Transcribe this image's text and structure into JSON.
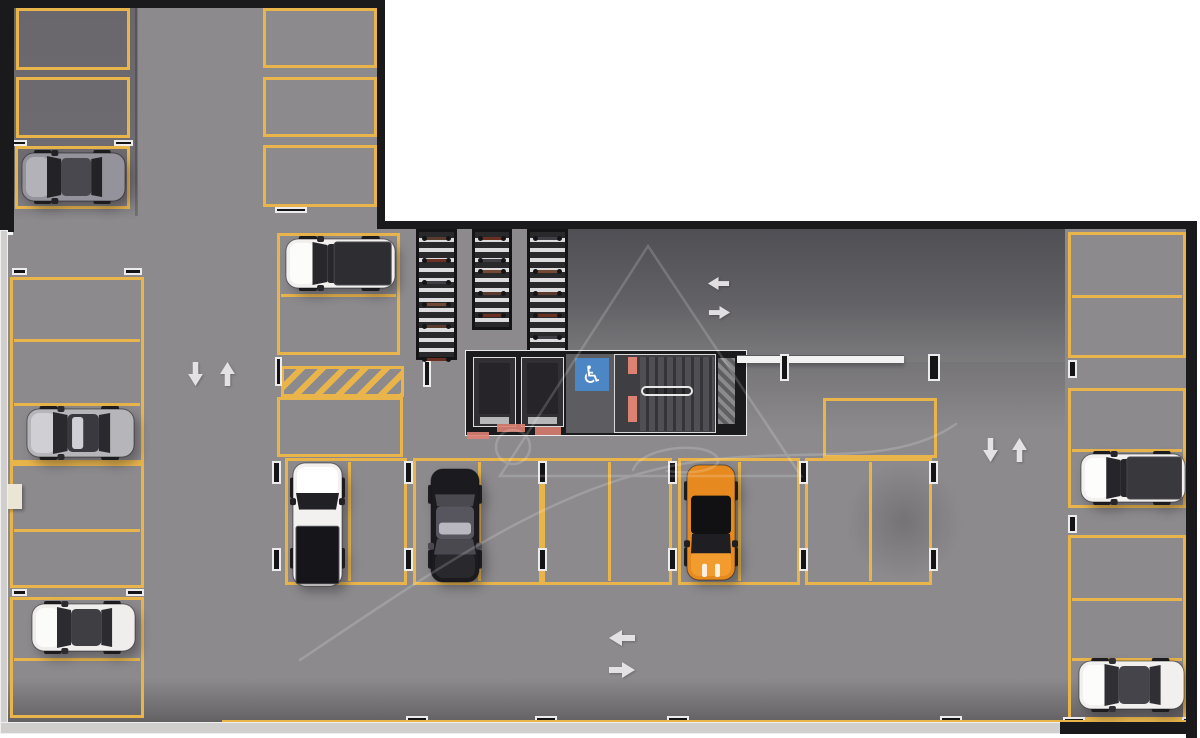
{
  "scene": {
    "type": "parking-garage-floor-plan",
    "view": "top-down-3d-render",
    "width": 1200,
    "height": 738
  },
  "palette": {
    "floor": "#8c8a8d",
    "floor_dark_nook": "#6d6b6f",
    "floor_dark_zone": "#565559",
    "marking_yellow": "#e9b54b",
    "wall_dark": "#1a191c",
    "wall_light": "#d0cfcd",
    "arrow_white": "#eceaec",
    "accessible_blue": "#4d86c4",
    "marking_red": "#dd8273",
    "rack_stripe": "#dcdbdd",
    "watermark": "#ffffff"
  },
  "stats": {
    "total_marked_spaces": 34,
    "occupied_spaces": 9,
    "empty_spaces": 25,
    "bike_racks": 3,
    "elevators": 2,
    "stairwells": 1,
    "accessible_signs": 1,
    "no_parking_zones": 1,
    "direction_arrows": 8
  },
  "icons": {
    "accessible_glyph": "♿"
  },
  "floors": [
    {
      "id": "floor-upper-wing",
      "rect": [
        8,
        6,
        371,
        222
      ],
      "fill": "base"
    },
    {
      "id": "floor-lower-wing",
      "rect": [
        8,
        225,
        1180,
        499
      ],
      "fill": "base"
    },
    {
      "id": "floor-entry-nook",
      "rect": [
        14,
        8,
        123,
        212
      ],
      "fill": "dark_nook"
    },
    {
      "id": "floor-drive-dark",
      "rect": [
        563,
        229,
        502,
        133
      ],
      "fill": "dark_zone"
    },
    {
      "id": "floor-drive-fade",
      "rect": [
        740,
        362,
        325,
        70
      ],
      "fill": "dark_fade"
    },
    {
      "id": "floor-bottom-shadow",
      "rect": [
        8,
        678,
        1178,
        44
      ],
      "fill": "bottom_shadow"
    }
  ],
  "walls": [
    {
      "id": "wall-top-upper-wing",
      "rect": [
        0,
        0,
        385,
        8
      ],
      "tone": "dark"
    },
    {
      "id": "wall-left-upper",
      "rect": [
        0,
        0,
        14,
        232
      ],
      "tone": "dark"
    },
    {
      "id": "wall-right-upper-wing",
      "rect": [
        377,
        0,
        8,
        229
      ],
      "tone": "dark"
    },
    {
      "id": "wall-top-lower-wing",
      "rect": [
        377,
        221,
        815,
        8
      ],
      "tone": "dark"
    },
    {
      "id": "wall-right",
      "rect": [
        1186,
        221,
        11,
        517
      ],
      "tone": "dark"
    },
    {
      "id": "wall-left-lower",
      "rect": [
        0,
        230,
        8,
        494
      ],
      "tone": "light"
    },
    {
      "id": "wall-bottom-left",
      "rect": [
        0,
        722,
        1062,
        12
      ],
      "tone": "light"
    },
    {
      "id": "wall-bottom-right",
      "rect": [
        1060,
        722,
        137,
        12
      ],
      "tone": "dark"
    }
  ],
  "openings": [
    {
      "id": "wall-opening-left",
      "rect": [
        0,
        213,
        13,
        22
      ],
      "color": "#f2f4f4"
    }
  ],
  "pillar": {
    "rect": [
      7,
      484,
      15,
      25
    ],
    "color": "#eae5d4"
  },
  "yellow_wall_stripe": {
    "rect": [
      222,
      720,
      966,
      5
    ]
  },
  "space_groups": [
    {
      "id": "nook-space-1",
      "rect": [
        16,
        8,
        114,
        62
      ],
      "dividers_y": [],
      "dividers_x": []
    },
    {
      "id": "nook-space-2",
      "rect": [
        16,
        77,
        114,
        61
      ],
      "dividers_y": [],
      "dividers_x": []
    },
    {
      "id": "nook-space-3",
      "rect": [
        15,
        146,
        115,
        63
      ],
      "dividers_y": [],
      "dividers_x": []
    },
    {
      "id": "left-col-group-1",
      "rect": [
        10,
        277,
        134,
        186
      ],
      "dividers_y": [
        338,
        402
      ],
      "dividers_x": []
    },
    {
      "id": "left-col-group-2",
      "rect": [
        10,
        463,
        134,
        125
      ],
      "dividers_y": [
        528
      ],
      "dividers_x": []
    },
    {
      "id": "left-col-group-3",
      "rect": [
        10,
        597,
        134,
        121
      ],
      "dividers_y": [
        657
      ],
      "dividers_x": []
    },
    {
      "id": "col2-top-space-1",
      "rect": [
        263,
        8,
        114,
        60
      ],
      "dividers_y": [],
      "dividers_x": []
    },
    {
      "id": "col2-top-space-2",
      "rect": [
        263,
        77,
        114,
        60
      ],
      "dividers_y": [],
      "dividers_x": []
    },
    {
      "id": "col2-top-space-3",
      "rect": [
        263,
        145,
        114,
        62
      ],
      "dividers_y": [],
      "dividers_x": []
    },
    {
      "id": "col2-suv-group",
      "rect": [
        277,
        233,
        123,
        122
      ],
      "dividers_y": [
        293
      ],
      "dividers_x": []
    },
    {
      "id": "col2-parallel-space",
      "rect": [
        277,
        397,
        126,
        60
      ],
      "dividers_y": [],
      "dividers_x": []
    },
    {
      "id": "mid-row-group-a",
      "rect": [
        285,
        458,
        122,
        127
      ],
      "dividers_y": [],
      "dividers_x": [
        347
      ]
    },
    {
      "id": "mid-row-group-b",
      "rect": [
        413,
        458,
        129,
        127
      ],
      "dividers_y": [],
      "dividers_x": [
        477
      ]
    },
    {
      "id": "mid-row-group-c",
      "rect": [
        542,
        458,
        130,
        127
      ],
      "dividers_y": [],
      "dividers_x": [
        607
      ]
    },
    {
      "id": "mid-row-group-d",
      "rect": [
        678,
        458,
        122,
        127
      ],
      "dividers_y": [],
      "dividers_x": [
        737
      ]
    },
    {
      "id": "mid-row-group-e",
      "rect": [
        805,
        458,
        127,
        127
      ],
      "dividers_y": [],
      "dividers_x": [
        868
      ]
    },
    {
      "id": "lobby-side-space",
      "rect": [
        823,
        398,
        114,
        60
      ],
      "dividers_y": [],
      "dividers_x": []
    },
    {
      "id": "right-col-group-1",
      "rect": [
        1068,
        232,
        118,
        126
      ],
      "dividers_y": [
        294
      ],
      "dividers_x": []
    },
    {
      "id": "right-col-group-2",
      "rect": [
        1068,
        388,
        118,
        120
      ],
      "dividers_y": [
        448
      ],
      "dividers_x": []
    },
    {
      "id": "right-col-group-3",
      "rect": [
        1068,
        535,
        118,
        185
      ],
      "dividers_y": [
        597,
        657
      ],
      "dividers_x": []
    }
  ],
  "no_parking_zone": {
    "rect": [
      281,
      366,
      123,
      31
    ],
    "pattern": "diagonal-yellow-stripes"
  },
  "posts": [
    [
      12,
      140,
      15,
      6
    ],
    [
      114,
      140,
      19,
      6
    ],
    [
      12,
      268,
      15,
      7
    ],
    [
      124,
      268,
      18,
      7
    ],
    [
      12,
      589,
      15,
      7
    ],
    [
      126,
      589,
      18,
      7
    ],
    [
      275,
      207,
      32,
      6
    ],
    [
      275,
      357,
      7,
      29
    ],
    [
      423,
      360,
      8,
      27
    ],
    [
      272,
      461,
      9,
      23
    ],
    [
      272,
      548,
      9,
      23
    ],
    [
      404,
      461,
      9,
      23
    ],
    [
      404,
      548,
      9,
      23
    ],
    [
      538,
      461,
      9,
      23
    ],
    [
      538,
      548,
      9,
      23
    ],
    [
      668,
      461,
      9,
      23
    ],
    [
      668,
      548,
      9,
      23
    ],
    [
      799,
      461,
      9,
      23
    ],
    [
      799,
      548,
      9,
      23
    ],
    [
      929,
      461,
      9,
      23
    ],
    [
      929,
      548,
      9,
      23
    ],
    [
      1068,
      360,
      9,
      18
    ],
    [
      1068,
      515,
      9,
      18
    ],
    [
      35,
      722,
      18,
      6
    ],
    [
      138,
      722,
      16,
      6
    ],
    [
      406,
      716,
      22,
      7
    ],
    [
      535,
      716,
      22,
      7
    ],
    [
      667,
      716,
      22,
      7
    ],
    [
      940,
      716,
      22,
      7
    ],
    [
      1063,
      717,
      22,
      7
    ],
    [
      1182,
      717,
      12,
      7
    ]
  ],
  "bike_area": {
    "racks": [
      {
        "id": "bike-rack-1",
        "rect": [
          416,
          229,
          41,
          131
        ],
        "bike_rows": [
          0,
          2,
          4,
          6,
          8,
          11
        ]
      },
      {
        "id": "bike-rack-2",
        "rect": [
          472,
          229,
          40,
          101
        ],
        "bike_rows": [
          0,
          2,
          3,
          5,
          7
        ]
      },
      {
        "id": "bike-rack-3",
        "rect": [
          527,
          229,
          41,
          129
        ],
        "bike_rows": [
          0,
          3,
          5,
          7,
          9,
          11
        ]
      }
    ],
    "bike_colors": [
      "#5a3a2c",
      "#6b2f22",
      "#3f3e44",
      "#724a33"
    ]
  },
  "lobby": {
    "outer": [
      465,
      350,
      282,
      86
    ],
    "elevators": [
      [
        473,
        357,
        43,
        70
      ],
      [
        521,
        357,
        43,
        70
      ]
    ],
    "corridor": [
      566,
      354,
      48,
      79
    ],
    "accessible_sign": [
      575,
      358,
      34,
      33
    ],
    "stair_block": [
      614,
      354,
      102,
      79
    ],
    "treads": [
      640,
      357,
      74,
      74
    ],
    "railing": [
      641,
      386,
      52,
      10
    ],
    "shaft": [
      716,
      356,
      21,
      70
    ],
    "beam": [
      737,
      355,
      167,
      8
    ],
    "beam_posts": [
      [
        780,
        354,
        9,
        27
      ],
      [
        928,
        354,
        12,
        27
      ]
    ],
    "stair_red_stripes": [
      [
        628,
        357,
        9,
        17
      ],
      [
        628,
        396,
        9,
        26
      ]
    ]
  },
  "red_marks": [
    [
      497,
      424,
      28,
      8
    ],
    [
      535,
      427,
      26,
      8
    ],
    [
      467,
      432,
      22,
      7
    ]
  ],
  "arrows": [
    {
      "id": "arrow-aisle-left-down",
      "pos": [
        188,
        362
      ],
      "dir": "down",
      "size": [
        15,
        24
      ]
    },
    {
      "id": "arrow-aisle-left-up",
      "pos": [
        220,
        362
      ],
      "dir": "up",
      "size": [
        15,
        24
      ]
    },
    {
      "id": "arrow-upper-right-left",
      "pos": [
        707,
        277
      ],
      "dir": "left",
      "size": [
        23,
        13
      ]
    },
    {
      "id": "arrow-upper-right-right",
      "pos": [
        708,
        306
      ],
      "dir": "right",
      "size": [
        23,
        13
      ]
    },
    {
      "id": "arrow-right-aisle-down",
      "pos": [
        983,
        438
      ],
      "dir": "down",
      "size": [
        15,
        24
      ]
    },
    {
      "id": "arrow-right-aisle-up",
      "pos": [
        1012,
        438
      ],
      "dir": "up",
      "size": [
        15,
        24
      ]
    },
    {
      "id": "arrow-bottom-left",
      "pos": [
        608,
        630
      ],
      "dir": "left",
      "size": [
        28,
        16
      ]
    },
    {
      "id": "arrow-bottom-right",
      "pos": [
        608,
        662
      ],
      "dir": "right",
      "size": [
        28,
        16
      ]
    }
  ],
  "cars": [
    {
      "id": "car-gray-hatchback",
      "type": "hatch",
      "rect": [
        20,
        149,
        108,
        56
      ],
      "facing": "left",
      "colors": {
        "body": "#94929a",
        "hood": "#b3b2b8",
        "glass": "#232226",
        "roof": "#49484e"
      }
    },
    {
      "id": "car-silver-sedan",
      "type": "sedan",
      "rect": [
        25,
        405,
        112,
        56
      ],
      "facing": "left",
      "colors": {
        "body": "#b6b5b9",
        "hood": "#d0d0d4",
        "glass": "#2a292d",
        "roof": "#3a3940",
        "sun": "#cfcfd5"
      }
    },
    {
      "id": "car-white-crossover",
      "type": "sedan",
      "rect": [
        30,
        600,
        108,
        55
      ],
      "facing": "left",
      "colors": {
        "body": "#efeeec",
        "hood": "#fbfbfa",
        "glass": "#2c2b2f",
        "roof": "#3f3e43"
      }
    },
    {
      "id": "car-white-suv-roofbox",
      "type": "suv-cargo",
      "rect": [
        284,
        235,
        114,
        57
      ],
      "facing": "left",
      "colors": {
        "body": "#f1f0ee",
        "hood": "#fcfcfb",
        "glass": "#28272b",
        "extra": "#2e2d31"
      }
    },
    {
      "id": "car-white-pickup",
      "type": "pickup",
      "rect": [
        289,
        461,
        57,
        128
      ],
      "facing": "up",
      "colors": {
        "body": "#f2f1ef",
        "hood": "#ffffff",
        "glass": "#212024",
        "extra": "#161519"
      }
    },
    {
      "id": "car-black-sedan",
      "type": "sedan",
      "rect": [
        427,
        466,
        56,
        118
      ],
      "facing": "down",
      "colors": {
        "body": "#1b1a1e",
        "hood": "#29282d",
        "glass": "#4a494f",
        "roof": "#57565e",
        "sun": "#b9b8c0"
      }
    },
    {
      "id": "car-orange-coupe",
      "type": "coupe",
      "rect": [
        683,
        462,
        56,
        120
      ],
      "facing": "down",
      "colors": {
        "body": "#e68a1f",
        "hood": "#f29b2e",
        "glass": "#1f1e22",
        "extra": "#111013"
      }
    },
    {
      "id": "car-white-suv-bed",
      "type": "suv-cargo",
      "rect": [
        1079,
        450,
        109,
        56
      ],
      "facing": "left",
      "colors": {
        "body": "#f2f1ef",
        "hood": "#fdfdfc",
        "glass": "#26252a",
        "extra": "#39383d"
      }
    },
    {
      "id": "car-white-sedan",
      "type": "sedan",
      "rect": [
        1077,
        657,
        110,
        56
      ],
      "facing": "left",
      "colors": {
        "body": "#f1f0ee",
        "hood": "#fcfcfb",
        "glass": "#302f34",
        "roof": "#45444a"
      }
    }
  ],
  "shadows": [
    {
      "id": "floor-shadow-blob",
      "rect": [
        845,
        462,
        118,
        118
      ]
    }
  ],
  "watermark": {
    "opacity": 0.17,
    "stroke": "#ffffff",
    "paths": [
      "M648 246 L500 476 L801 476 Z",
      "M496 447 a17 17 0 1 0 34 0 a17 17 0 1 0 -34 0",
      "M300 660 C455 556 565 480 700 461 C805 447 893 468 956 424",
      "M633 470 C641 447 702 441 716 456 C726 467 699 476 667 471"
    ]
  }
}
